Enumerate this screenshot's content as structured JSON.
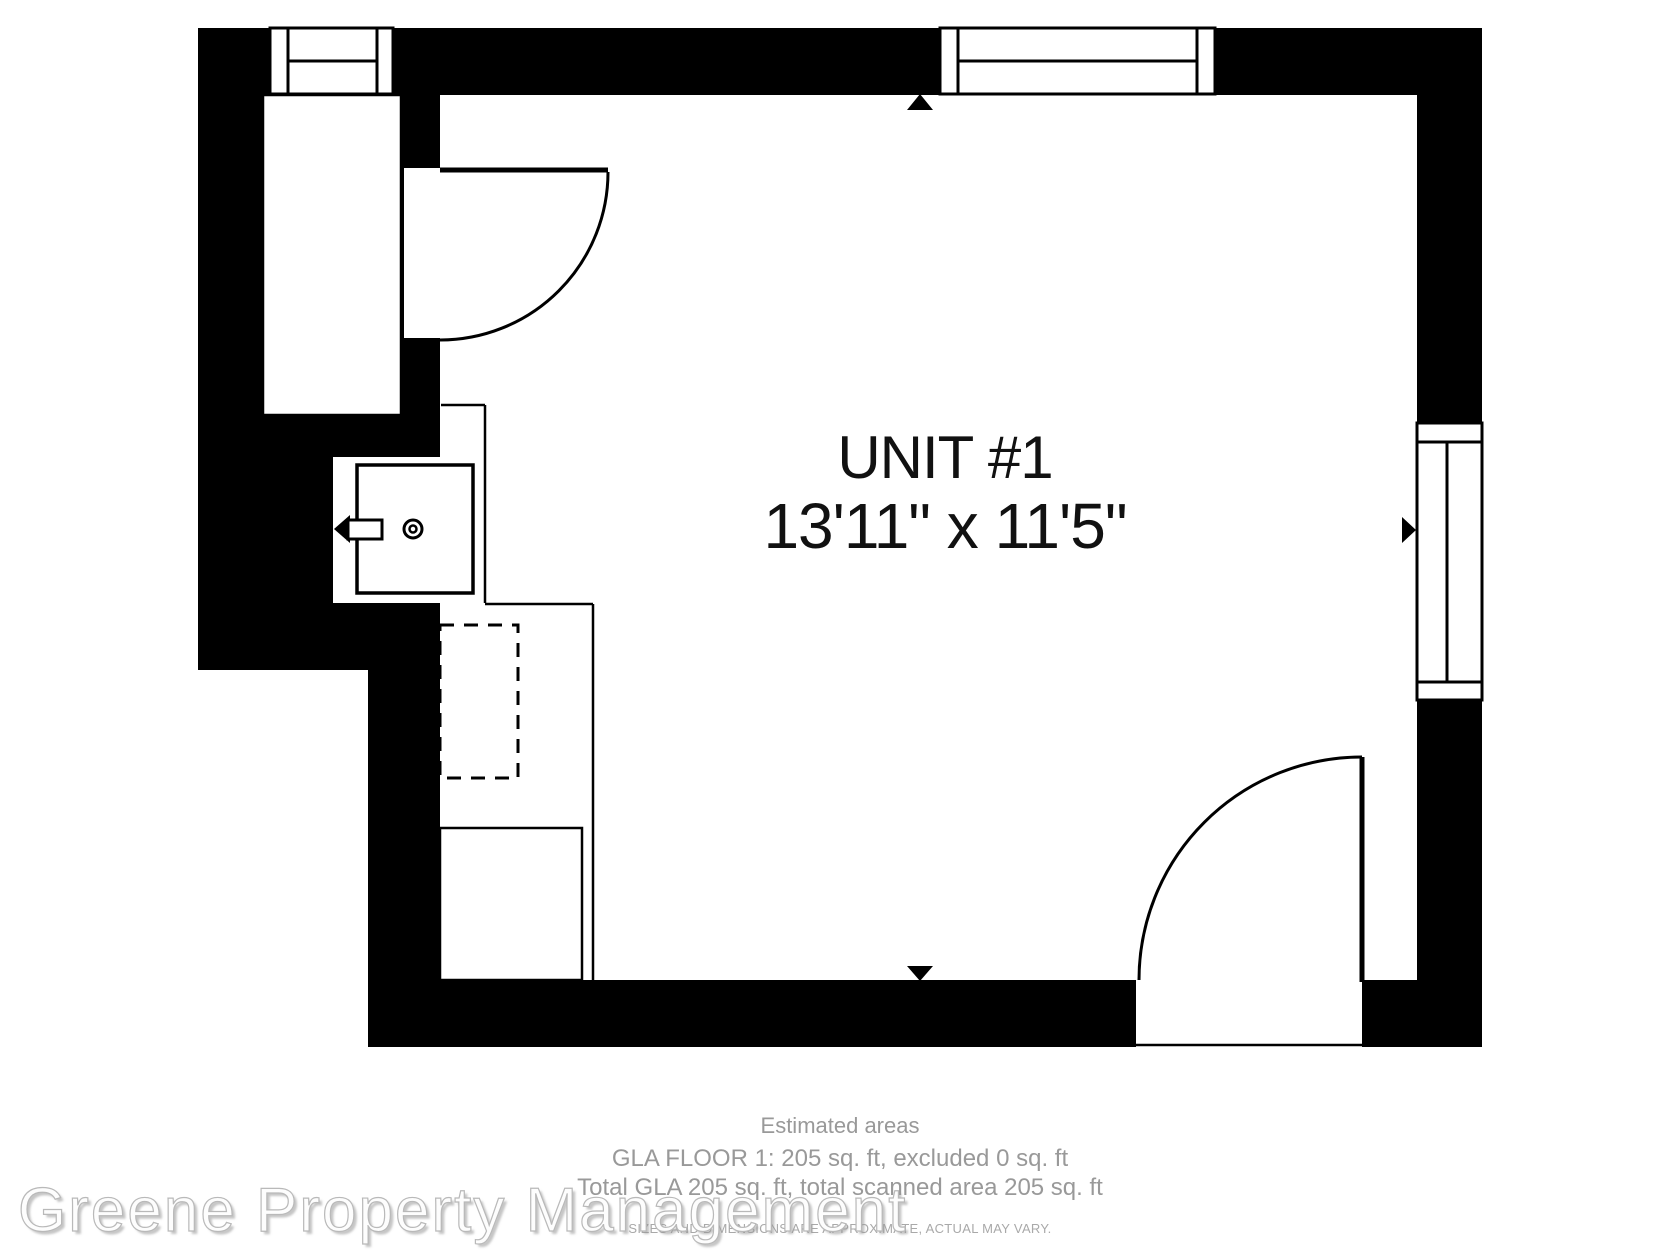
{
  "floorplan": {
    "unit_label": "UNIT #1",
    "unit_dimensions": "13'11\" x 11'5\"",
    "fixtures": [
      "window-top-left",
      "window-top-right",
      "window-right",
      "door-top-left",
      "door-bottom-right",
      "closet-alcove",
      "sink-unit",
      "faucet",
      "dishwasher-dashed",
      "cabinet",
      "kitchen-counter"
    ],
    "dimension_arrows": [
      "up",
      "down",
      "left",
      "right"
    ]
  },
  "footer": {
    "title": "Estimated areas",
    "gla_floor_line": "GLA FLOOR 1: 205 sq. ft, excluded 0 sq. ft",
    "total_gla_line": "Total GLA 205 sq. ft, total scanned area 205 sq. ft",
    "disclaimer": "SIZES AND DIMENSIONS ARE APPROXIMATE, ACTUAL MAY VARY."
  },
  "watermark": {
    "text": "Greene Property Management"
  },
  "colors": {
    "walls": "#000000",
    "floor": "#ffffff",
    "label_text": "#111111",
    "footer_text": "#999999",
    "disclaimer_text": "#a9a9a9",
    "watermark_fill": "#fdfdfd",
    "watermark_outline": "#b9b9b9"
  }
}
